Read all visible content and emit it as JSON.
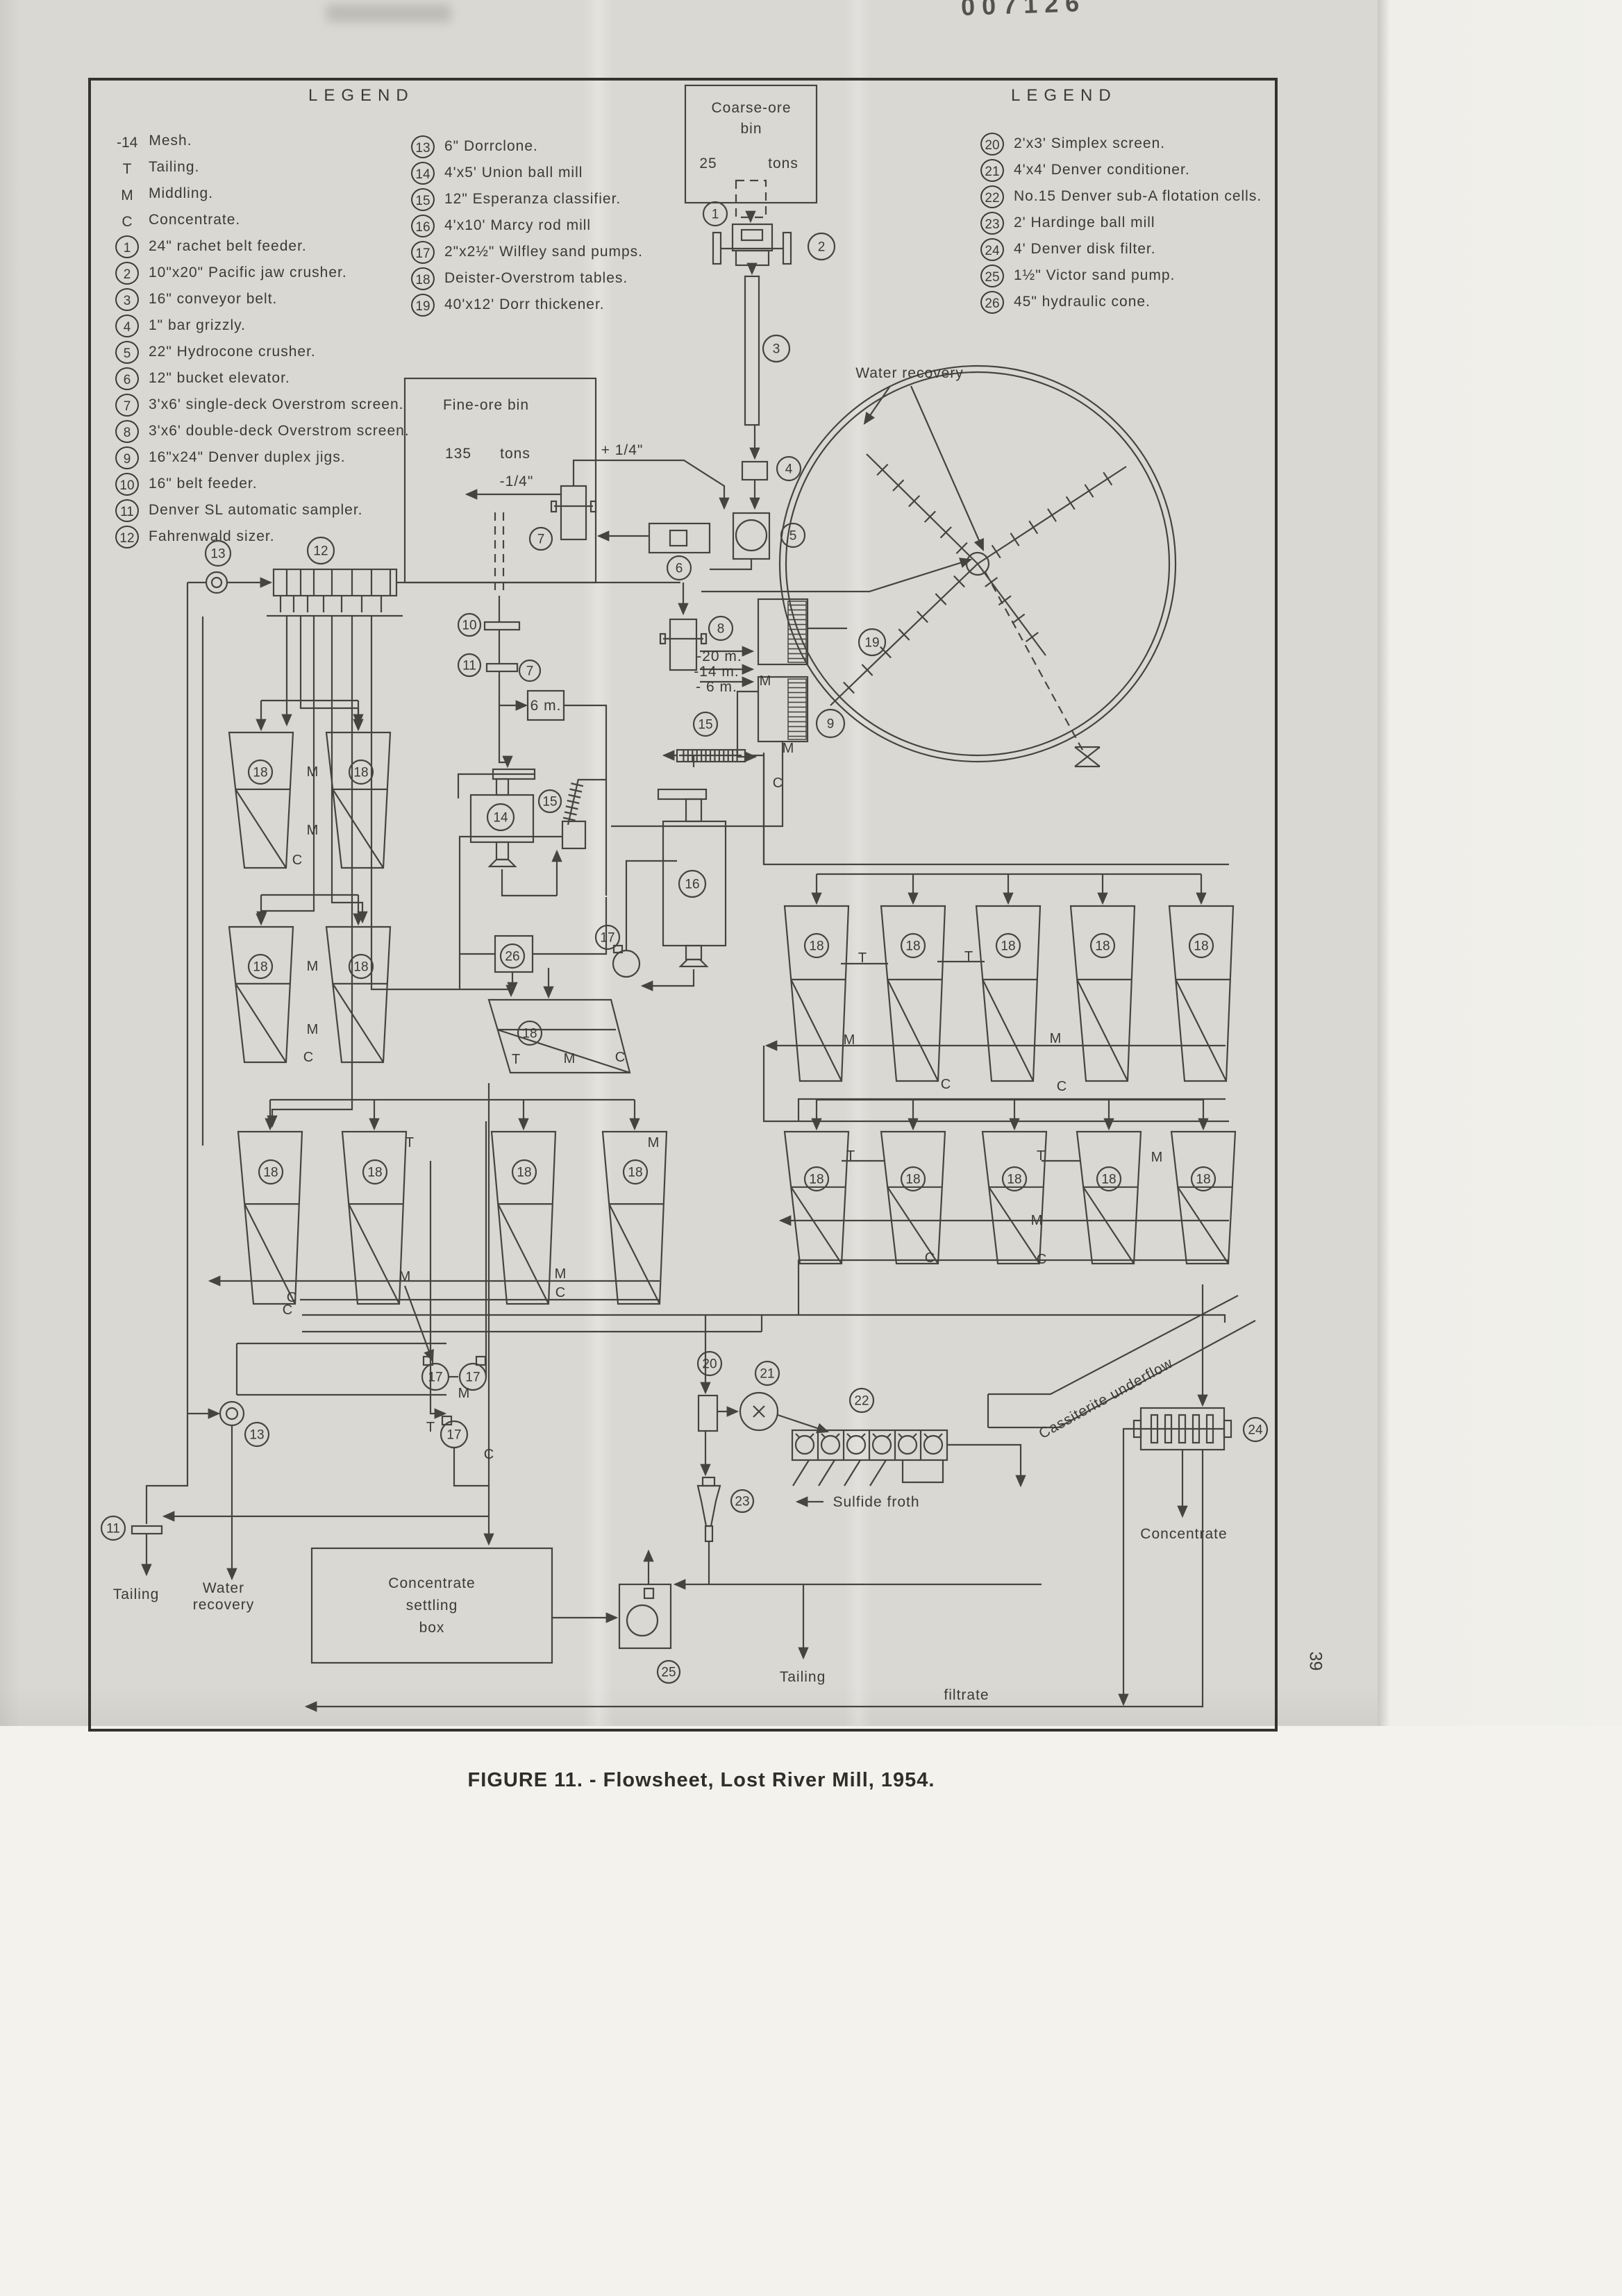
{
  "page": {
    "stamp": "007126",
    "page_number": "39",
    "caption": "FIGURE 11. - Flowsheet, Lost River Mill, 1954."
  },
  "legend_left": {
    "title": "LEGEND",
    "rows": [
      {
        "k": "-14",
        "t": "Mesh.",
        "c": false
      },
      {
        "k": "T",
        "t": "Tailing.",
        "c": false
      },
      {
        "k": "M",
        "t": "Middling.",
        "c": false
      },
      {
        "k": "C",
        "t": "Concentrate.",
        "c": false
      },
      {
        "k": "1",
        "t": "24\" rachet belt feeder.",
        "c": true
      },
      {
        "k": "2",
        "t": "10\"x20\" Pacific jaw crusher.",
        "c": true
      },
      {
        "k": "3",
        "t": "16\" conveyor belt.",
        "c": true
      },
      {
        "k": "4",
        "t": "1\" bar grizzly.",
        "c": true
      },
      {
        "k": "5",
        "t": "22\" Hydrocone crusher.",
        "c": true
      },
      {
        "k": "6",
        "t": "12\" bucket elevator.",
        "c": true
      },
      {
        "k": "7",
        "t": "3'x6' single-deck Overstrom screen.",
        "c": true
      },
      {
        "k": "8",
        "t": "3'x6' double-deck Overstrom screen.",
        "c": true
      },
      {
        "k": "9",
        "t": "16\"x24\" Denver duplex jigs.",
        "c": true
      },
      {
        "k": "10",
        "t": "16\" belt feeder.",
        "c": true
      },
      {
        "k": "11",
        "t": "Denver SL automatic sampler.",
        "c": true
      },
      {
        "k": "12",
        "t": "Fahrenwald sizer.",
        "c": true
      }
    ]
  },
  "legend_middle": {
    "rows": [
      {
        "k": "13",
        "t": "6\" Dorrclone.",
        "c": true
      },
      {
        "k": "14",
        "t": "4'x5' Union ball mill",
        "c": true
      },
      {
        "k": "15",
        "t": "12\" Esperanza classifier.",
        "c": true
      },
      {
        "k": "16",
        "t": "4'x10' Marcy rod mill",
        "c": true
      },
      {
        "k": "17",
        "t": "2\"x2½\" Wilfley sand pumps.",
        "c": true
      },
      {
        "k": "18",
        "t": "Deister-Overstrom tables.",
        "c": true
      },
      {
        "k": "19",
        "t": "40'x12' Dorr thickener.",
        "c": true
      }
    ]
  },
  "legend_right": {
    "title": "LEGEND",
    "rows": [
      {
        "k": "20",
        "t": "2'x3' Simplex screen.",
        "c": true
      },
      {
        "k": "21",
        "t": "4'x4' Denver conditioner.",
        "c": true
      },
      {
        "k": "22",
        "t": "No.15 Denver sub-A flotation cells.",
        "c": true
      },
      {
        "k": "23",
        "t": "2' Hardinge ball mill",
        "c": true
      },
      {
        "k": "24",
        "t": "4' Denver disk filter.",
        "c": true
      },
      {
        "k": "25",
        "t": "1½\" Victor sand pump.",
        "c": true
      },
      {
        "k": "26",
        "t": "45\" hydraulic cone.",
        "c": true
      }
    ]
  },
  "diagram": {
    "coarse_bin": {
      "line1": "Coarse-ore",
      "line2": "bin",
      "tons_num": "25",
      "tons_unit": "tons"
    },
    "fine_bin": {
      "line1": "Fine-ore bin",
      "tons_num": "135",
      "tons_unit": "tons"
    },
    "settling_box": {
      "line1": "Concentrate",
      "line2": "settling",
      "line3": "box"
    },
    "labels": {
      "water_recovery_top": "Water recovery",
      "plus_quarter": "+ 1/4\"",
      "minus_quarter": "-1/4\"",
      "mesh20": "-20 m.",
      "mesh14": "-14 m.",
      "mesh6": "- 6 m.",
      "six_m": "6 m.",
      "cassiterite": "Cassiterite  underflow",
      "sulfide_froth": "Sulfide  froth",
      "concentrate_right": "Concentrate",
      "tailing_left": "Tailing",
      "water_bottom_1": "Water",
      "water_bottom_2": "recovery",
      "tailing_mid": "Tailing",
      "filtrate": "filtrate"
    },
    "markers": [
      [
        "1",
        1030,
        308,
        17
      ],
      [
        "2",
        1183,
        355,
        19
      ],
      [
        "3",
        1118,
        502,
        19
      ],
      [
        "4",
        1136,
        675,
        17
      ],
      [
        "5",
        1142,
        771,
        17
      ],
      [
        "6",
        978,
        818,
        17
      ],
      [
        "7",
        779,
        776,
        16
      ],
      [
        "7",
        763,
        966,
        15
      ],
      [
        "8",
        1038,
        905,
        17
      ],
      [
        "9",
        1196,
        1042,
        20
      ],
      [
        "10",
        676,
        900,
        16
      ],
      [
        "11",
        676,
        958,
        16
      ],
      [
        "12",
        462,
        793,
        19
      ],
      [
        "13",
        314,
        797,
        18
      ],
      [
        "14",
        721,
        1177,
        19
      ],
      [
        "15",
        792,
        1154,
        16
      ],
      [
        "15",
        1016,
        1043,
        17
      ],
      [
        "16",
        997,
        1273,
        19
      ],
      [
        "17",
        875,
        1350,
        17
      ],
      [
        "18",
        375,
        1112,
        17
      ],
      [
        "18",
        520,
        1112,
        17
      ],
      [
        "18",
        375,
        1392,
        17
      ],
      [
        "18",
        520,
        1392,
        17
      ],
      [
        "18",
        763,
        1488,
        17
      ],
      [
        "18",
        390,
        1688,
        17
      ],
      [
        "18",
        540,
        1688,
        17
      ],
      [
        "18",
        755,
        1688,
        17
      ],
      [
        "18",
        915,
        1688,
        17
      ],
      [
        "18",
        1176,
        1362,
        17
      ],
      [
        "18",
        1315,
        1362,
        17
      ],
      [
        "18",
        1452,
        1362,
        17
      ],
      [
        "18",
        1588,
        1362,
        17
      ],
      [
        "18",
        1730,
        1362,
        17
      ],
      [
        "18",
        1176,
        1698,
        17
      ],
      [
        "18",
        1315,
        1698,
        17
      ],
      [
        "18",
        1461,
        1698,
        17
      ],
      [
        "18",
        1597,
        1698,
        17
      ],
      [
        "18",
        1733,
        1698,
        17
      ],
      [
        "19",
        1256,
        925,
        19
      ],
      [
        "20",
        1022,
        1964,
        17
      ],
      [
        "21",
        1105,
        1978,
        17
      ],
      [
        "22",
        1241,
        2017,
        17
      ],
      [
        "23",
        1069,
        2162,
        16
      ],
      [
        "24",
        1808,
        2059,
        17
      ],
      [
        "25",
        963,
        2408,
        16
      ],
      [
        "26",
        738,
        1377,
        17
      ],
      [
        "13",
        370,
        2066,
        17
      ],
      [
        "11",
        163,
        2201,
        17
      ],
      [
        "17",
        627,
        1983,
        19
      ],
      [
        "17",
        681,
        1983,
        19
      ],
      [
        "17",
        654,
        2066,
        19
      ]
    ],
    "flow_letters": [
      [
        "M",
        1102,
        987
      ],
      [
        "M",
        1135,
        1084
      ],
      [
        "C",
        1120,
        1134
      ],
      [
        "M",
        450,
        1118
      ],
      [
        "M",
        450,
        1202
      ],
      [
        "C",
        428,
        1245
      ],
      [
        "M",
        450,
        1398
      ],
      [
        "M",
        450,
        1489
      ],
      [
        "C",
        444,
        1529
      ],
      [
        "T",
        743,
        1532
      ],
      [
        "M",
        820,
        1531
      ],
      [
        "C",
        893,
        1529
      ],
      [
        "T",
        590,
        1652
      ],
      [
        "M",
        941,
        1652
      ],
      [
        "M",
        583,
        1845
      ],
      [
        "M",
        807,
        1841
      ],
      [
        "C",
        807,
        1868
      ],
      [
        "C",
        420,
        1875
      ],
      [
        "M",
        668,
        2013
      ],
      [
        "T",
        620,
        2062
      ],
      [
        "C",
        704,
        2101
      ],
      [
        "C",
        414,
        1893
      ],
      [
        "T",
        1242,
        1386
      ],
      [
        "T",
        1395,
        1384
      ],
      [
        "M",
        1223,
        1504
      ],
      [
        "M",
        1520,
        1502
      ],
      [
        "C",
        1362,
        1568
      ],
      [
        "C",
        1529,
        1571
      ],
      [
        "T",
        1225,
        1671
      ],
      [
        "T",
        1499,
        1671
      ],
      [
        "M",
        1666,
        1673
      ],
      [
        "M",
        1493,
        1764
      ],
      [
        "C",
        1339,
        1818
      ],
      [
        "C",
        1500,
        1820
      ]
    ]
  }
}
